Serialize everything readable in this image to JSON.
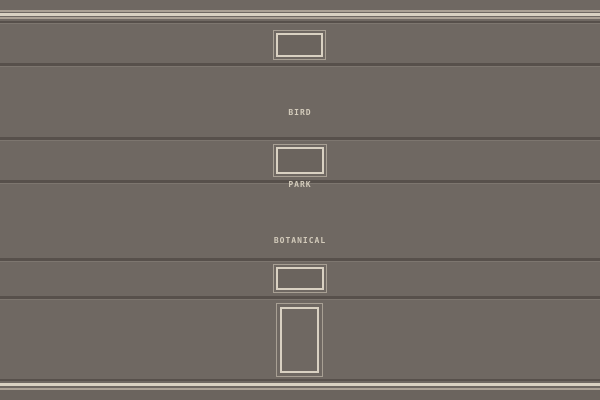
{
  "colors": {
    "wall": "#6F6862",
    "wall_dark": "#6B645E",
    "floor": "#6B645E",
    "separator": "#57504B",
    "separator_highlight": "#7D766F",
    "molding_light": "#ACA296",
    "molding_cream": "#D9D1C2",
    "frame_outer": "#A8A094",
    "frame_inner": "#D9D1C2",
    "frame_interior": "#6B645E",
    "sign_text": "#D3CBBB"
  },
  "signs": [
    {
      "id": "bird-in-the-park",
      "lines": [
        "BIRD",
        "IN THE",
        "PARK"
      ]
    },
    {
      "id": "botanical-garden",
      "lines": [
        "BOTANICAL",
        "GARDEN"
      ]
    }
  ]
}
